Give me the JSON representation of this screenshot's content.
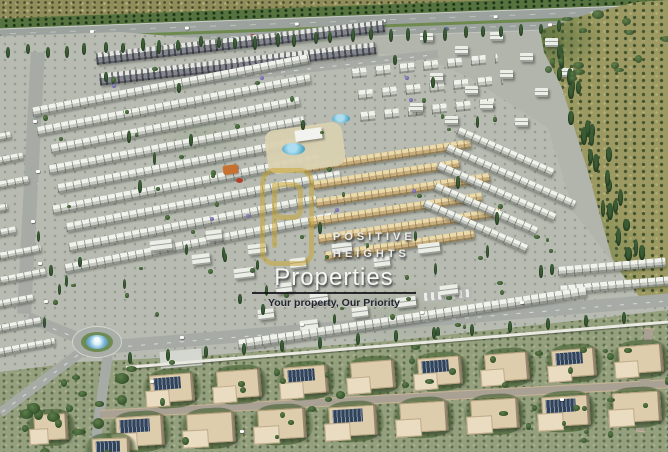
{
  "watermark": {
    "brand_line1": "POSITIVE",
    "brand_line2": "HEIGHTS",
    "brand_name": "Properties",
    "tagline": "Your property, Our Priority",
    "logo_icon": "p-monogram-rounded-square-icon",
    "logo_color": "#c9a227"
  },
  "palette": {
    "scrub_olive": "#8f8d58",
    "field_olive": "#9c9a60",
    "tree_green_dark": "#22381f",
    "tree_green_mid": "#4a6b3d",
    "jacaranda_purple": "#7b6fa8",
    "highway_gray": "#9ba19c",
    "road_gray": "#a6aaa5",
    "road_tan": "#a8a092",
    "building_white": "#eef0ea",
    "building_gold": "#ead9a9",
    "villa_roof_tan": "#dccbaa",
    "solar_navy": "#33445a",
    "pool_blue": "#59aecb",
    "lawn_green": "#6d8b51",
    "pink_field": "#c08098"
  }
}
